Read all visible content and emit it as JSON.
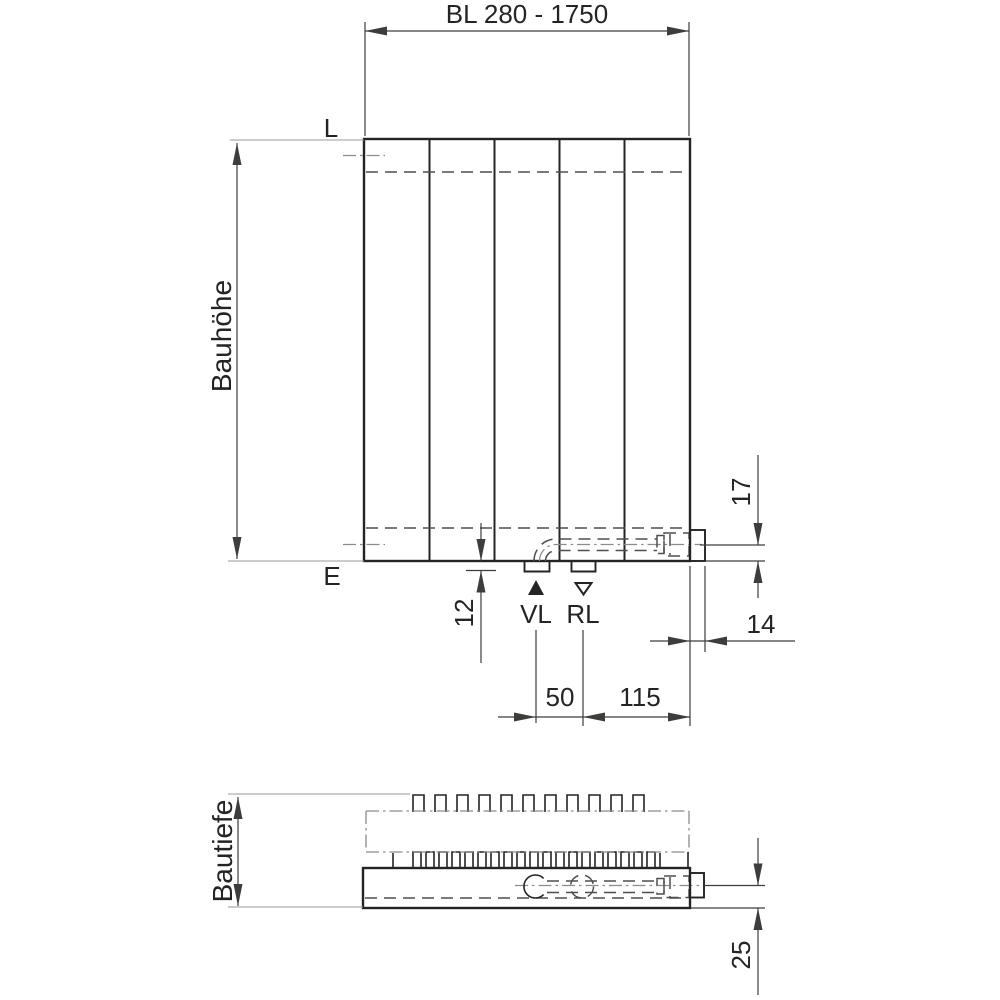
{
  "labels": {
    "bl_range": "BL 280 - 1750",
    "construction_height": "Bauhöhe",
    "construction_depth": "Bautiefe",
    "level_top": "L",
    "level_bottom": "E",
    "supply": "VL",
    "return_flow": "RL"
  },
  "dimensions": {
    "connection_center_to_bottom": "17",
    "connection_stub_drop": "12",
    "side_protrusion": "14",
    "supply_return_spacing": "50",
    "return_to_right_edge": "115",
    "pipe_center_to_front": "25"
  },
  "front_view": {
    "panel_count": 5
  },
  "colors": {
    "background": "#ffffff",
    "outline": "#242424",
    "dimension": "#3d3d3c",
    "extension": "#9a9a98",
    "hidden_dashed": "#4e4e4c",
    "centerline": "#8c8c8a"
  }
}
